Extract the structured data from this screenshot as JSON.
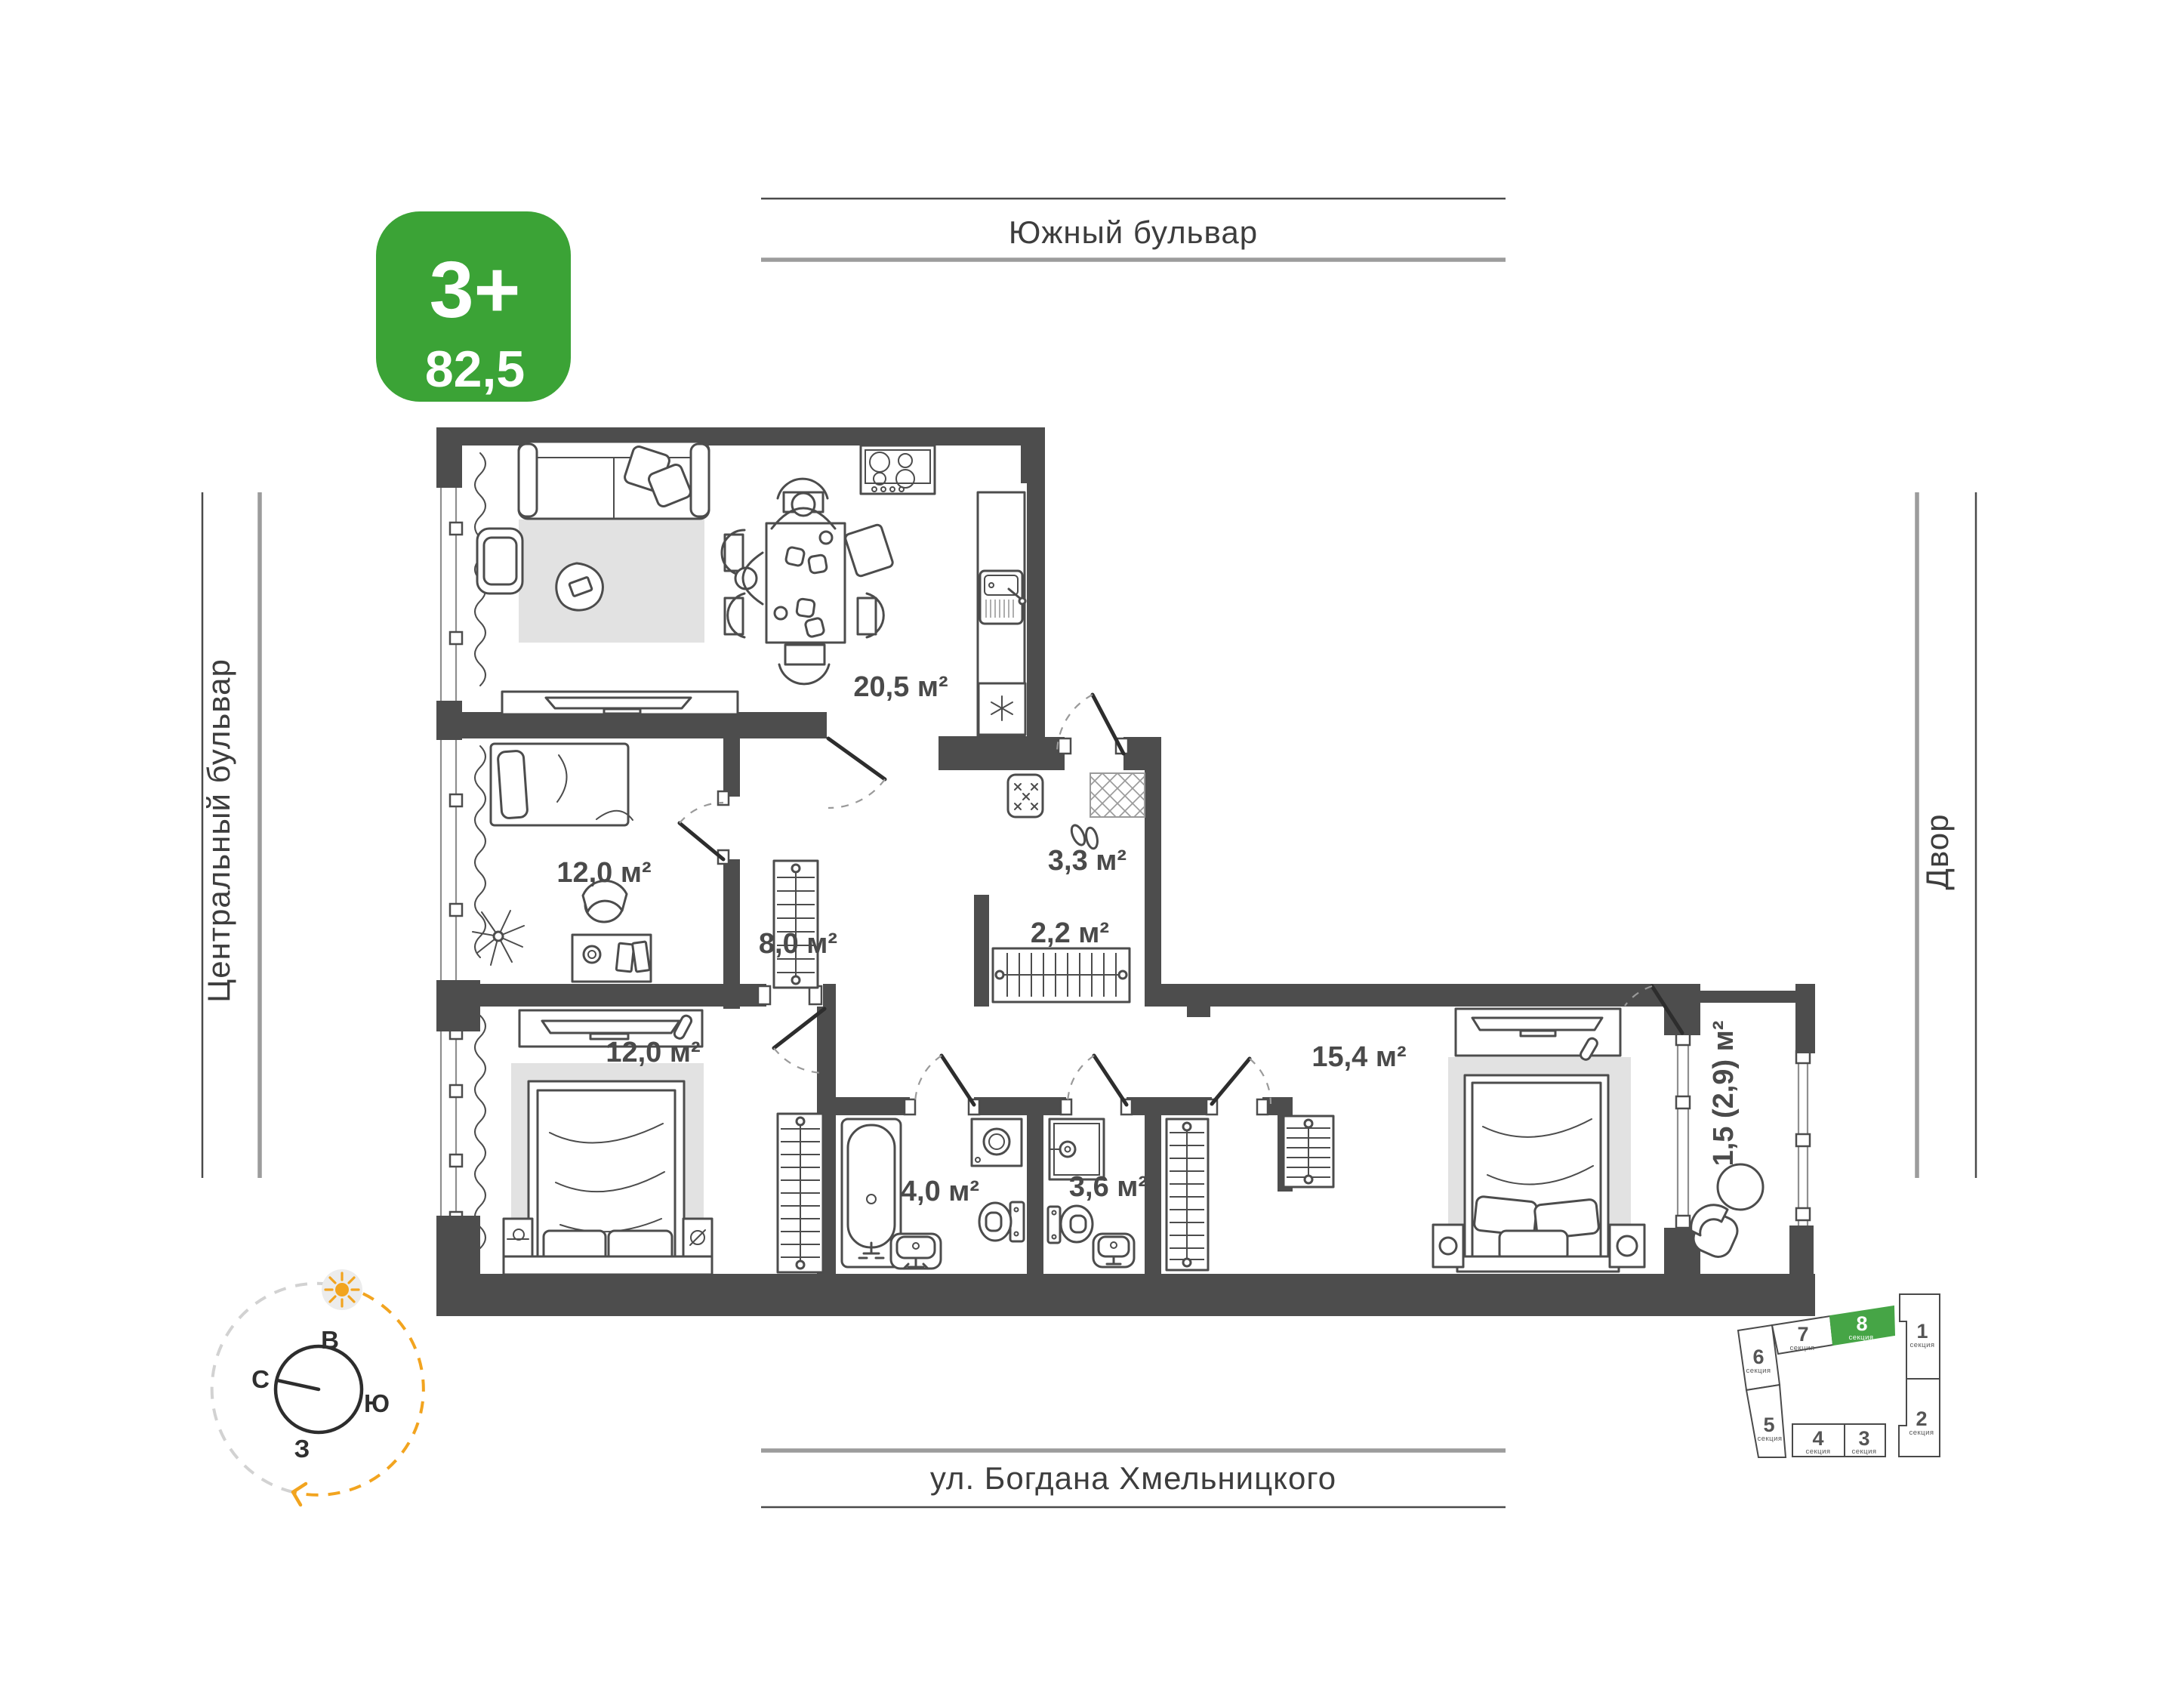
{
  "badge": {
    "room_type": "3+",
    "area_value": "82,5",
    "color": "#3BA336"
  },
  "streets": {
    "top": "Южный бульвар",
    "left": "Центральный бульвар",
    "right": "Двор",
    "bottom": "ул. Богдана Хмельницкого"
  },
  "plan": {
    "rooms": [
      {
        "name": "kitchen-living-room",
        "label": "20,5 м²"
      },
      {
        "name": "bedroom-1",
        "label": "12,0 м²"
      },
      {
        "name": "bedroom-2",
        "label": "12,0 м²"
      },
      {
        "name": "hallway",
        "label": "8,0 м²"
      },
      {
        "name": "entry",
        "label": "3,3 м²"
      },
      {
        "name": "wardrobe",
        "label": "2,2 м²"
      },
      {
        "name": "bathroom",
        "label": "4,0 м²"
      },
      {
        "name": "shower-room",
        "label": "3,6 м²"
      },
      {
        "name": "bedroom-3",
        "label": "15,4 м²"
      },
      {
        "name": "balcony",
        "label": "1,5 (2,9) м²"
      }
    ]
  },
  "compass": {
    "east": "В",
    "south": "Ю",
    "west": "З",
    "north": "С"
  },
  "section_map": {
    "section_word": "секция",
    "highlighted": "8",
    "sections": [
      "1",
      "2",
      "3",
      "4",
      "5",
      "6",
      "7",
      "8"
    ]
  },
  "colors": {
    "accent_green": "#3BA336",
    "wall_gray": "#4D4D4D",
    "sun_orange": "#F2A41F"
  }
}
